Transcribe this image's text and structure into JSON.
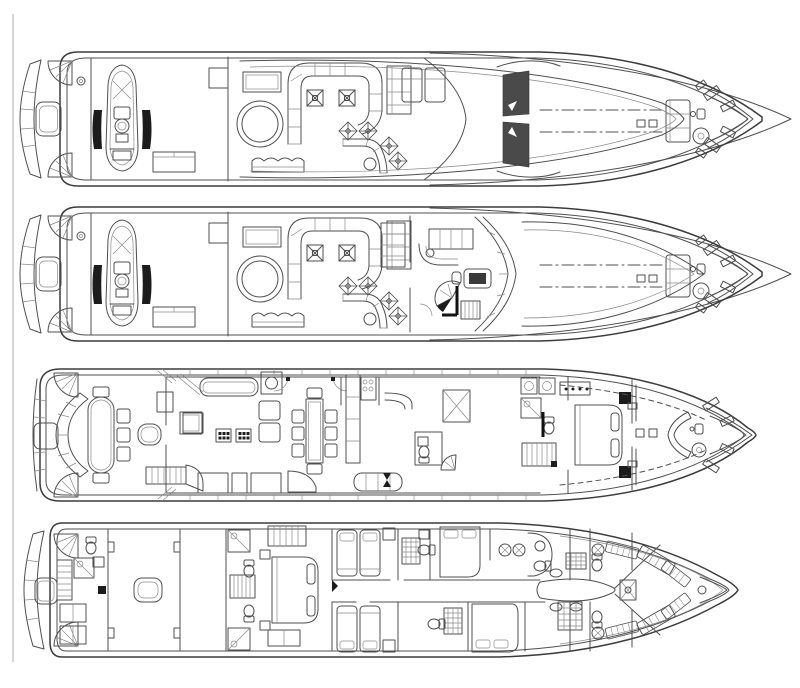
{
  "document": {
    "type": "yacht-general-arrangement-blueprint",
    "background_color": "#ffffff",
    "line_color": "#4f4f4f",
    "heavy_line_color": "#3c3c3c",
    "light_line_color": "#8a8a8a",
    "dark_fill_color": "#1c1c1c",
    "page_edge_color": "#9a9a9a"
  },
  "decks": [
    {
      "id": "flybridge",
      "name": "Flybridge sun deck plan",
      "features": [
        "swim-platform transom",
        "tender with chocks",
        "davit bench",
        "jacuzzi",
        "U-shaped settee",
        "bar tables with parasols",
        "curved wet bar with stools",
        "sun loungers",
        "radar arch",
        "bow sunpad",
        "anchor windlass",
        "bow pulpit seats"
      ]
    },
    {
      "id": "bridge-deck",
      "name": "Bridge deck plan",
      "features": [
        "tender with chocks",
        "jacuzzi",
        "U-shaped settee",
        "bar tables",
        "curved wet bar with stools",
        "pilothouse settee",
        "chart cabinet",
        "helm console",
        "spiral staircase",
        "raked windshield",
        "bow sunpad",
        "anchor windlass"
      ]
    },
    {
      "id": "main-deck",
      "name": "Main deck plan",
      "features": [
        "aft-deck curved settee",
        "oval cockpit table",
        "wet bar",
        "cockpit stairs",
        "salon sofa",
        "armchairs",
        "coffee tables",
        "dining table for eight",
        "galley",
        "dumb waiter",
        "stair foyer",
        "day head",
        "master stateroom with double bed",
        "vanity",
        "bow bench",
        "anchor windlass"
      ]
    },
    {
      "id": "lower-deck",
      "name": "Lower deck plan",
      "features": [
        "swim platform",
        "lazarette with head and stairs",
        "engine room with hatch",
        "tank room",
        "guest heads",
        "full-beam VIP cabin",
        "twin guest cabins",
        "double guest cabins",
        "laundry",
        "crew mess table",
        "crew heads with showers",
        "crew bunks",
        "chain locker forepeak"
      ]
    }
  ]
}
